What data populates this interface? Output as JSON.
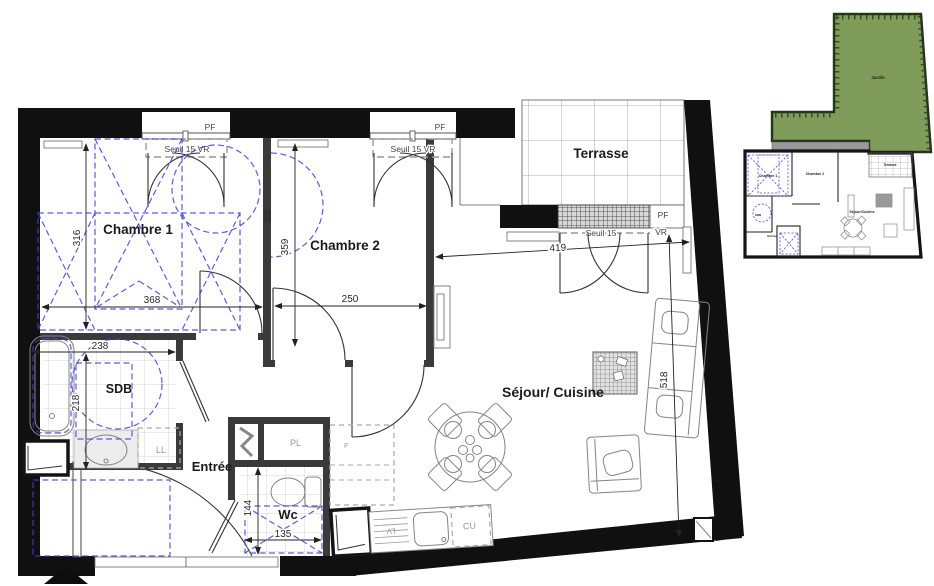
{
  "plan": {
    "rooms": {
      "chambre1": "Chambre 1",
      "chambre2": "Chambre 2",
      "sdb": "SDB",
      "entree": "Entrée",
      "wc": "Wc",
      "sejour": "Séjour/ Cuisine",
      "terrasse": "Terrasse"
    },
    "dims": {
      "chambre1_w": "368",
      "chambre1_h": "316",
      "chambre2_w": "250",
      "chambre2_h": "359",
      "sdb_w": "238",
      "sdb_h": "218",
      "wc_w": "135",
      "wc_h": "144",
      "sejour_w": "419",
      "sejour_h": "518"
    },
    "openings": {
      "pf": "PF",
      "seuil_vr": "Seuil 15  VR",
      "seuil": "Seuil 15",
      "vr": "VR"
    },
    "appliances": {
      "ll": "LL",
      "pl": "PL",
      "f": "F",
      "lv": "LV",
      "cu": "CU"
    }
  },
  "minimap": {
    "jardin": "Jardin",
    "terrasse": "Terrasse",
    "chambre1": "Chambre 1",
    "chambre2": "Chambre 2",
    "sejour": "Séjour/Cuisine",
    "sdb": "SDB",
    "entree": "Entrée"
  },
  "colors": {
    "wall": "#101010",
    "interior_wall": "#3a3a3a",
    "accessibility_blue": "#4040dd",
    "garden_green": "#7f9c5a"
  }
}
